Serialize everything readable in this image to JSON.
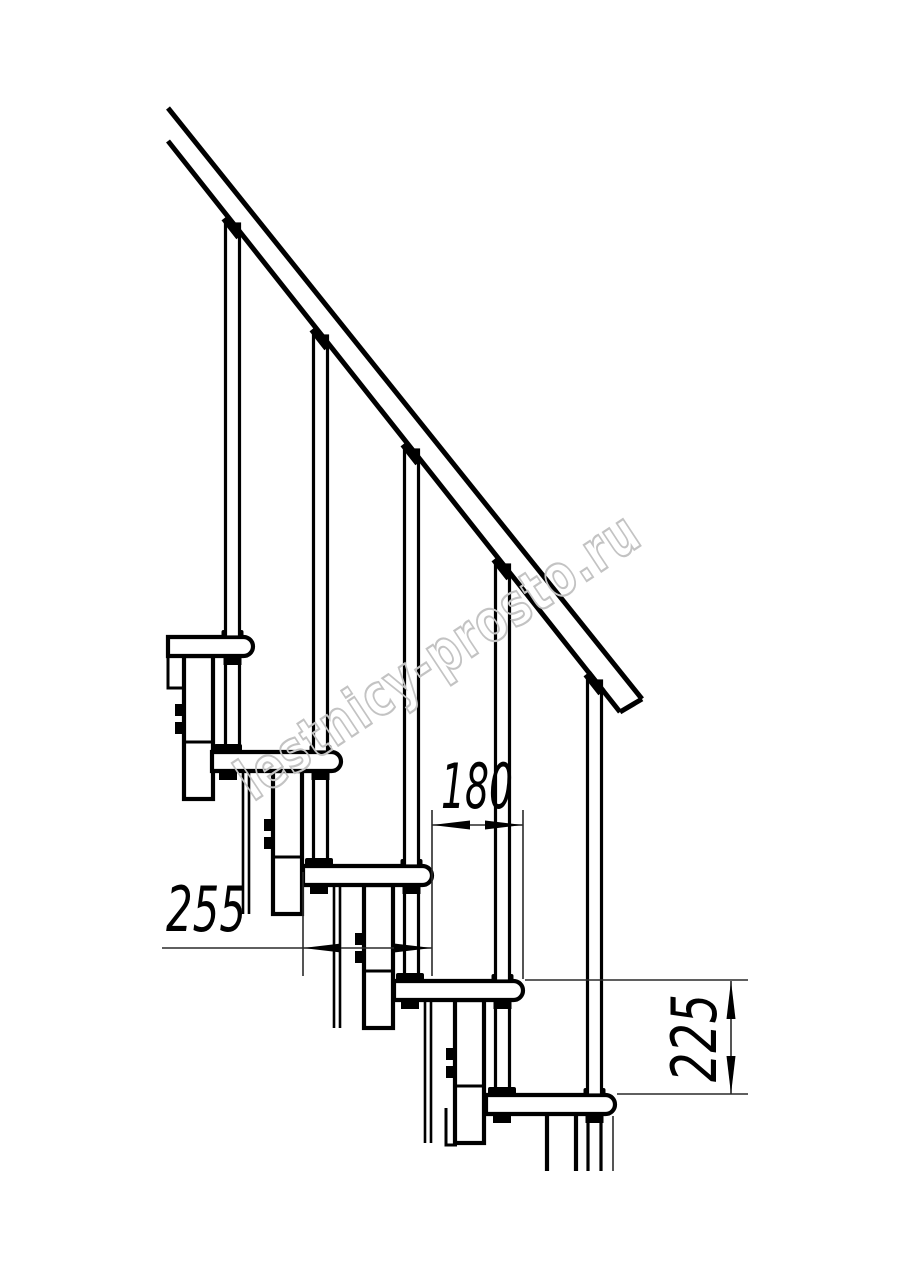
{
  "drawing": {
    "watermark": "lestnicy-prosto.ru",
    "dimensions": {
      "tread_depth": "255",
      "going": "180",
      "rise": "225"
    }
  }
}
